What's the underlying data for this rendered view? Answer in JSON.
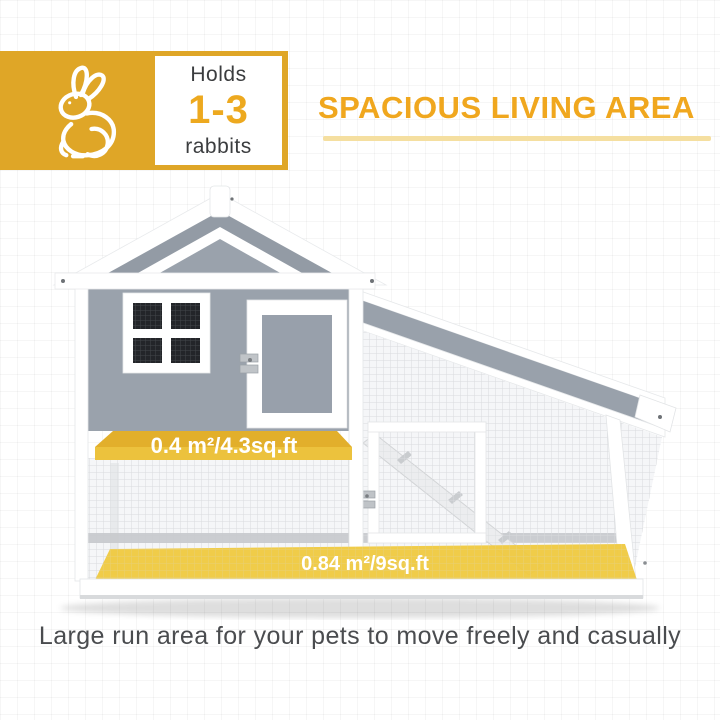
{
  "badge": {
    "icon": "rabbit-icon",
    "line1": "Holds",
    "value": "1-3",
    "line2": "rabbits",
    "bg_color": "#DFA627",
    "value_color": "#EDA91F"
  },
  "headline": {
    "text": "SPACIOUS LIVING AREA",
    "color": "#F0A71E",
    "underline_color": "#F5DFA0"
  },
  "hutch": {
    "upper_floor_label": "0.4 m²/4.3sq.ft",
    "lower_floor_label": "0.84 m²/9sq.ft",
    "banner_color": "#ECC23D",
    "floor_highlight_color": "#EFC93F",
    "wall_color": "#9AA2AC",
    "roof_color": "#99A1AB"
  },
  "caption": {
    "text": "Large run area for your pets to move freely and casually",
    "color": "#4A4C4F"
  }
}
